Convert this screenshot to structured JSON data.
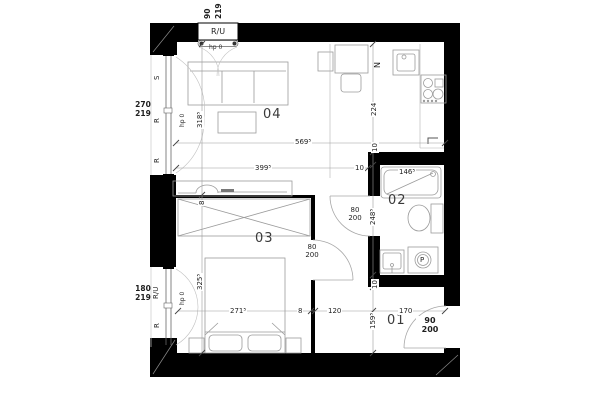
{
  "rooms": {
    "r01": "01",
    "r02": "02",
    "r03": "03",
    "r04": "04"
  },
  "dims": {
    "total_width": "569⁵",
    "living_width": "399⁵",
    "living_height": "318⁵",
    "bedroom_height": "325⁵",
    "bedroom_width": "271⁵",
    "partition_h": "8",
    "partition_v": "8",
    "corridor_width": "120",
    "kitchen_depth": "224",
    "wall10_top": "10",
    "wall10_bottom": "10",
    "wall10_left": "10",
    "bath_height": "248⁵",
    "bath_width": "146⁵",
    "hall_height": "159⁵",
    "hall_width": "170"
  },
  "windows": {
    "top": {
      "size_w": "90",
      "size_h": "219",
      "label": "R/U",
      "note": "hp 0"
    },
    "left_upper": {
      "size_w": "270",
      "size_h": "219",
      "labels": [
        "S",
        "R",
        "R"
      ],
      "note": "hp 0"
    },
    "left_lower": {
      "size_w": "180",
      "size_h": "219",
      "labels": [
        "R/U",
        "R"
      ],
      "note": "hp 0"
    }
  },
  "doors": {
    "bath": {
      "w": "80",
      "h": "200"
    },
    "bedroom": {
      "w": "80",
      "h": "200"
    },
    "entrance": {
      "w": "90",
      "h": "200"
    }
  },
  "annotations": {
    "north": "N",
    "washer": "P"
  },
  "colors": {
    "wall": "#000000",
    "furniture_line": "#9b9b9b",
    "dim_line": "#8a8a8a",
    "text": "#1e1e1e"
  }
}
